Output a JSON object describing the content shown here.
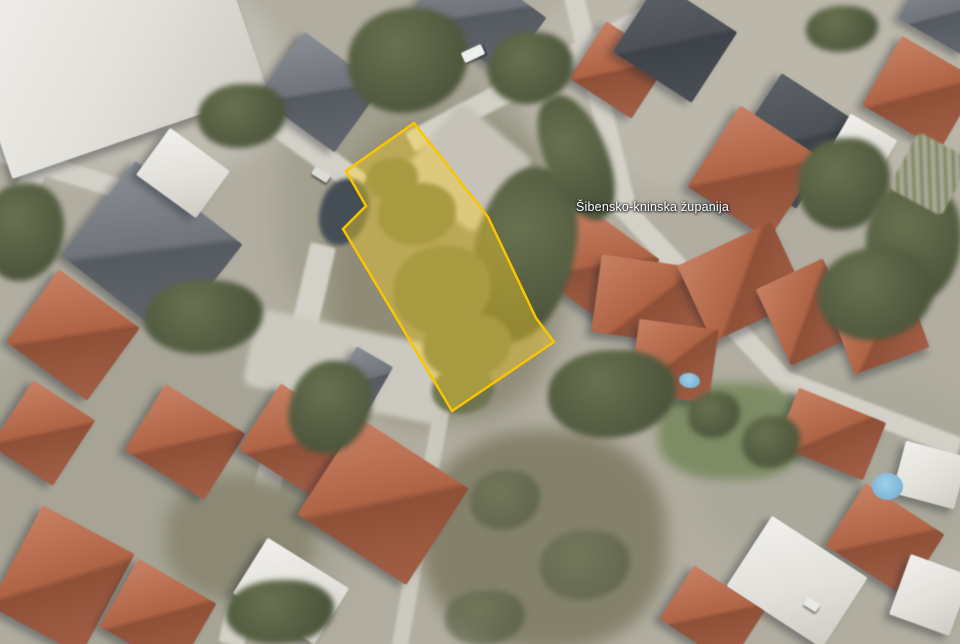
{
  "map": {
    "label": {
      "text": "Šibensko-kninska županija",
      "color": "#ffffff",
      "halo_color": "#3c4247",
      "x": 576,
      "y": 200
    },
    "parcel": {
      "stroke": "#f7c600",
      "fill": "rgba(255,212,40,0.40)",
      "stroke_width": 2.5,
      "points": [
        [
          414,
          123
        ],
        [
          488,
          217
        ],
        [
          536,
          318
        ],
        [
          554,
          342
        ],
        [
          452,
          411
        ],
        [
          343,
          229
        ],
        [
          366,
          206
        ],
        [
          346,
          171
        ]
      ]
    }
  }
}
